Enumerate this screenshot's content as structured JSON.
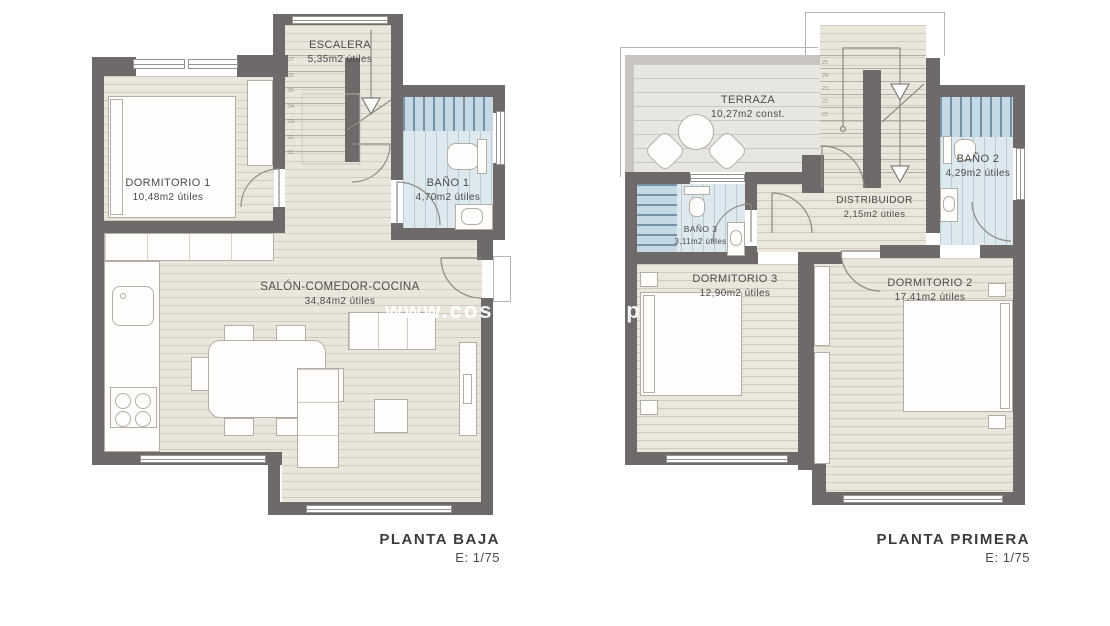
{
  "watermark": {
    "fragment1": "www.costa",
    "fragment2": "sp"
  },
  "colors": {
    "wall": "#6e6a69",
    "light_wall": "#c8c5c0",
    "floor": "#eae6dc",
    "terrace_floor": "#e8e6e1",
    "bath_floor": "#dde8ef",
    "shower_stripe": "#c5d8e4",
    "label_text": "#4b4b4b",
    "title_text": "#3c3c3c"
  },
  "plans": [
    {
      "id": "planta-baja",
      "title": "PLANTA BAJA",
      "scale": "E: 1/75",
      "stair_numbers": [
        "27",
        "26",
        "25",
        "24",
        "23",
        "22",
        "21"
      ],
      "rooms": {
        "escalera": {
          "name": "ESCALERA",
          "area": "5,35m2 útiles"
        },
        "dormitorio1": {
          "name": "DORMITORIO 1",
          "area": "10,48m2 útiles"
        },
        "bano1": {
          "name": "BAÑO 1",
          "area": "4,70m2 útiles"
        },
        "salon": {
          "name": "SALÓN-COMEDOR-COCINA",
          "area": "34,84m2 útiles"
        }
      }
    },
    {
      "id": "planta-primera",
      "title": "PLANTA PRIMERA",
      "scale": "E: 1/75",
      "stair_numbers": [
        "25",
        "24",
        "23",
        "22",
        "21"
      ],
      "rooms": {
        "terraza": {
          "name": "TERRAZA",
          "area": "10,27m2 const."
        },
        "bano2": {
          "name": "BAÑO 2",
          "area": "4,29m2 útiles"
        },
        "bano3": {
          "name": "BAÑO 3",
          "area": "3,11m2 útiles"
        },
        "distribuidor": {
          "name": "DISTRIBUIDOR",
          "area": "2,15m2 útiles"
        },
        "dormitorio3": {
          "name": "DORMITORIO 3",
          "area": "12,90m2 útiles"
        },
        "dormitorio2": {
          "name": "DORMITORIO 2",
          "area": "17,41m2 útiles"
        }
      }
    }
  ]
}
